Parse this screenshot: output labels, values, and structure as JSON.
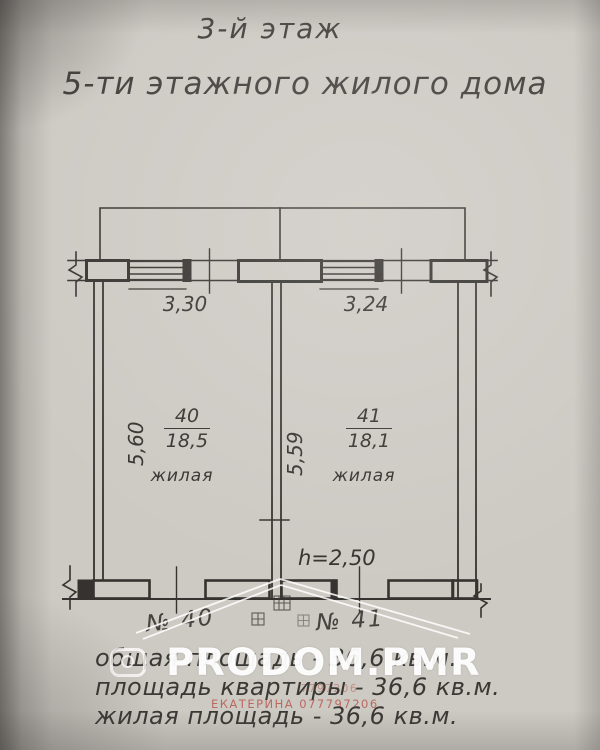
{
  "document": {
    "title_line1": "3-й этаж",
    "title_line2": "5-ти этажного жилого дома"
  },
  "plan": {
    "dimensions": {
      "window_left_width": "3,30",
      "window_right_width": "3,24",
      "room_left_depth": "5,60",
      "room_right_depth": "5,59",
      "ceiling_height": "h=2,50"
    },
    "rooms": [
      {
        "number": "40",
        "area": "18,5",
        "label": "жилая",
        "door_label": "№ 40"
      },
      {
        "number": "41",
        "area": "18,1",
        "label": "жилая",
        "door_label": "№ 41"
      }
    ]
  },
  "summary": {
    "total_area": "общая площадь - 36,6 кв.м.",
    "apartment_area": "площадь квартиры - 36,6 кв.м.",
    "living_area": "жилая площадь - 36,6 кв.м."
  },
  "watermark": {
    "brand": "PRODOM.PMR",
    "agent": "ЕКАТЕРИНА 077797206"
  },
  "colors": {
    "paper": "#cdc9c3",
    "ink": "#35332f",
    "watermark_white": "#ffffff",
    "watermark_red": "#b1443a"
  }
}
